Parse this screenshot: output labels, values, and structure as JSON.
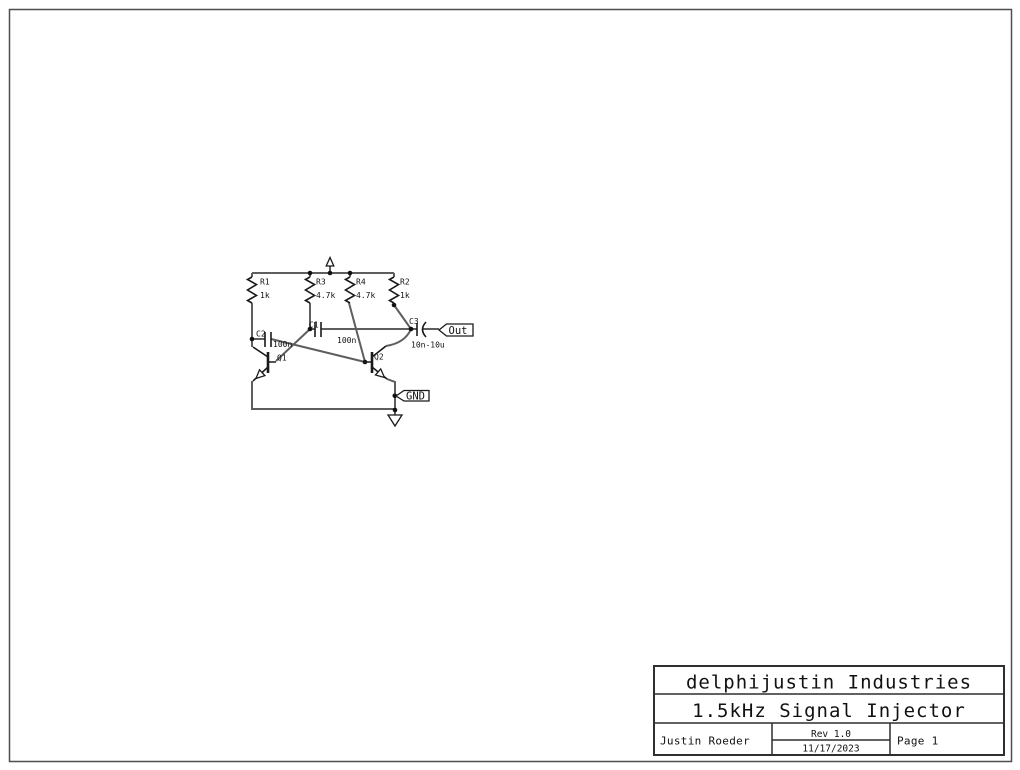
{
  "schematic": {
    "components": {
      "R1": {
        "ref": "R1",
        "value": "1k"
      },
      "R3": {
        "ref": "R3",
        "value": "4.7k"
      },
      "R4": {
        "ref": "R4",
        "value": "4.7k"
      },
      "R2": {
        "ref": "R2",
        "value": "1k"
      },
      "C2": {
        "ref": "C2",
        "value": "100n"
      },
      "C1": {
        "ref": "C1",
        "value": "100n"
      },
      "C3": {
        "ref": "C3",
        "value": "10n-10u"
      },
      "Q1": {
        "ref": "Q1"
      },
      "Q2": {
        "ref": "Q2"
      }
    },
    "net_flags": {
      "output": "Out",
      "ground": "GND"
    }
  },
  "title_block": {
    "company": "delphijustin Industries",
    "title": "1.5kHz Signal Injector",
    "author": "Justin Roeder",
    "revision": "Rev 1.0",
    "date": "11/17/2023",
    "page": "Page 1"
  },
  "colors": {
    "wire": "#5e5e5e",
    "symbol": "#1a1a1a",
    "text": "#111111"
  }
}
